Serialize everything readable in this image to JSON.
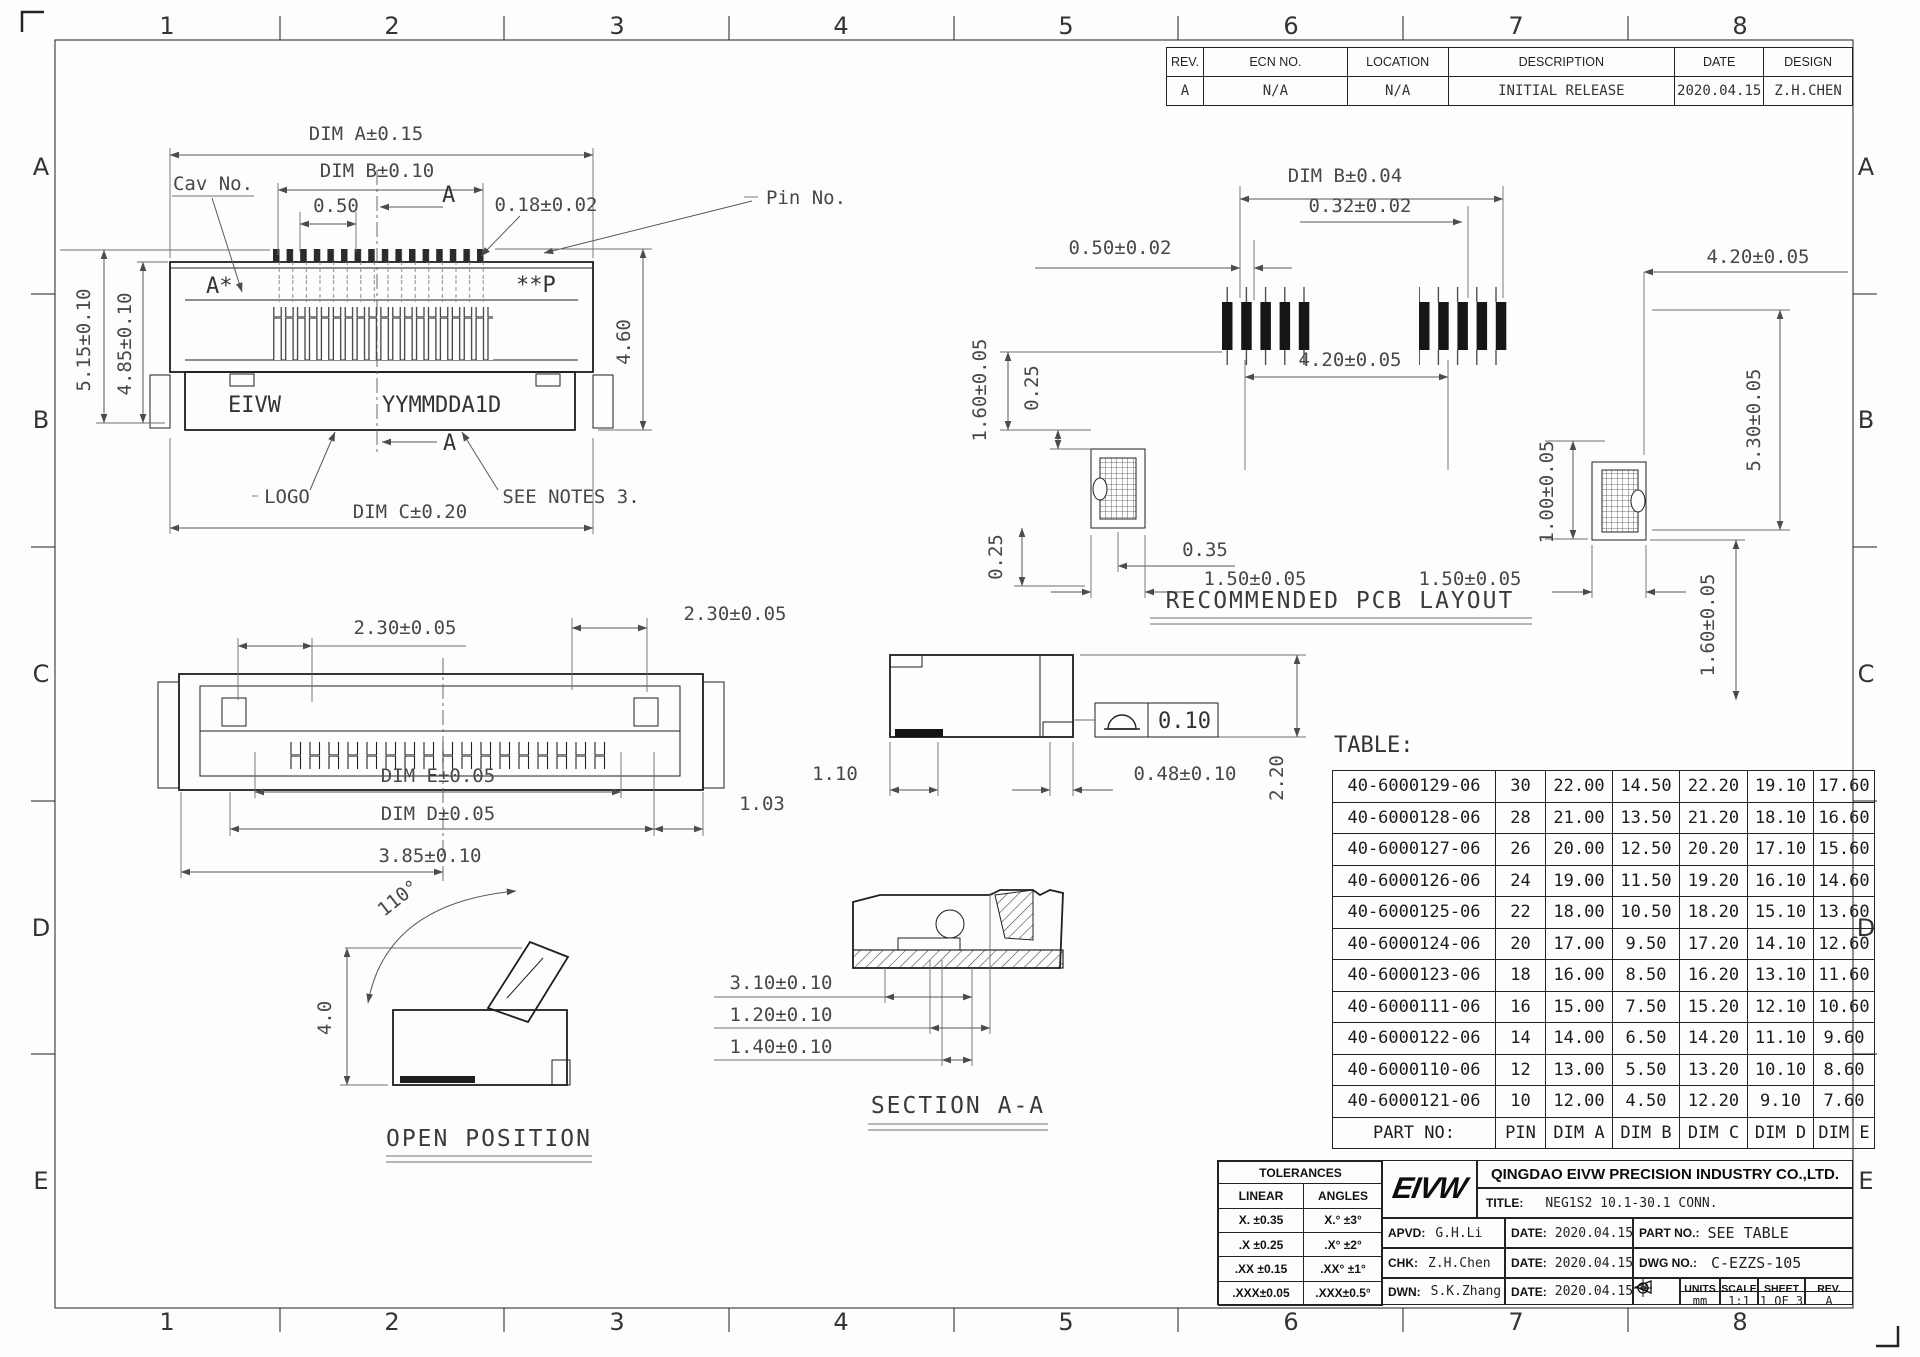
{
  "zones": {
    "cols": [
      "1",
      "2",
      "3",
      "4",
      "5",
      "6",
      "7",
      "8"
    ],
    "rows": [
      "A",
      "B",
      "C",
      "D",
      "E"
    ]
  },
  "revision_table": {
    "headers": [
      "REV.",
      "ECN NO.",
      "LOCATION",
      "DESCRIPTION",
      "DATE",
      "DESIGN"
    ],
    "row": [
      "A",
      "N/A",
      "N/A",
      "INITIAL RELEASE",
      "2020.04.15",
      "Z.H.CHEN"
    ]
  },
  "front_view": {
    "dim_a": "DIM A±0.15",
    "dim_b": "DIM B±0.10",
    "pitch": "0.50",
    "section_mark": "A",
    "section_mark_bottom": "A",
    "pin_width": "0.18±0.02",
    "cav_no": "Cav No.",
    "pin_no": "Pin No.",
    "mark_start": "A*",
    "mark_end": "**P",
    "brand": "EIVW",
    "date_code": "YYMMDDA1D",
    "logo_label": "LOGO",
    "notes_label": "SEE NOTES 3.",
    "dim_c": "DIM C±0.20",
    "height_outer": "5.15±0.10",
    "height_inner": "4.85±0.10",
    "depth": "4.60"
  },
  "pcb_view": {
    "dim_b": "DIM B±0.04",
    "pad_pitch": "0.50±0.02",
    "pad_width": "0.32±0.02",
    "span_right": "4.20±0.05",
    "span_center": "4.20±0.05",
    "edge_top": "1.60±0.05",
    "gap_top": "0.25",
    "gap_bottom": "0.25",
    "notch": "0.35",
    "anchor_left": "1.50±0.05",
    "anchor_right": "1.50±0.05",
    "offset_v": "1.00±0.05",
    "height_v": "5.30±0.05",
    "edge_bottom": "1.60±0.05",
    "caption": "RECOMMENDED PCB LAYOUT"
  },
  "bottom_view": {
    "tail_left": "2.30±0.05",
    "tail_right": "2.30±0.05",
    "dim_e": "DIM E±0.05",
    "dim_d": "DIM D±0.05",
    "overall": "3.85±0.10",
    "offset": "1.03"
  },
  "side_view": {
    "foot": "1.10",
    "tail": "0.48±0.10",
    "height": "2.20",
    "flatness": "0.10"
  },
  "open_view": {
    "angle": "110°",
    "height": "4.0",
    "caption": "OPEN POSITION"
  },
  "section_view": {
    "d1": "3.10±0.10",
    "d2": "1.20±0.10",
    "d3": "1.40±0.10",
    "caption": "SECTION A-A"
  },
  "part_table": {
    "label": "TABLE:",
    "columns": [
      "PART NO:",
      "PIN",
      "DIM A",
      "DIM B",
      "DIM C",
      "DIM D",
      "DIM E"
    ],
    "rows": [
      [
        "40-6000129-06",
        "30",
        "22.00",
        "14.50",
        "22.20",
        "19.10",
        "17.60"
      ],
      [
        "40-6000128-06",
        "28",
        "21.00",
        "13.50",
        "21.20",
        "18.10",
        "16.60"
      ],
      [
        "40-6000127-06",
        "26",
        "20.00",
        "12.50",
        "20.20",
        "17.10",
        "15.60"
      ],
      [
        "40-6000126-06",
        "24",
        "19.00",
        "11.50",
        "19.20",
        "16.10",
        "14.60"
      ],
      [
        "40-6000125-06",
        "22",
        "18.00",
        "10.50",
        "18.20",
        "15.10",
        "13.60"
      ],
      [
        "40-6000124-06",
        "20",
        "17.00",
        "9.50",
        "17.20",
        "14.10",
        "12.60"
      ],
      [
        "40-6000123-06",
        "18",
        "16.00",
        "8.50",
        "16.20",
        "13.10",
        "11.60"
      ],
      [
        "40-6000111-06",
        "16",
        "15.00",
        "7.50",
        "15.20",
        "12.10",
        "10.60"
      ],
      [
        "40-6000122-06",
        "14",
        "14.00",
        "6.50",
        "14.20",
        "11.10",
        "9.60"
      ],
      [
        "40-6000110-06",
        "12",
        "13.00",
        "5.50",
        "13.20",
        "10.10",
        "8.60"
      ],
      [
        "40-6000121-06",
        "10",
        "12.00",
        "4.50",
        "12.20",
        "9.10",
        "7.60"
      ]
    ]
  },
  "title_block": {
    "tolerances": {
      "title": "TOLERANCES",
      "linear_label": "LINEAR",
      "angles_label": "ANGLES",
      "rows": [
        [
          "X.  ±0.35",
          "X.°  ±3°"
        ],
        [
          ".X  ±0.25",
          ".X°  ±2°"
        ],
        [
          ".XX ±0.15",
          ".XX° ±1°"
        ],
        [
          ".XXX±0.05",
          ".XXX±0.5°"
        ]
      ]
    },
    "logo": "EIVW",
    "company": "QINGDAO EIVW PRECISION INDUSTRY CO.,LTD.",
    "title_label": "TITLE:",
    "title": "NEG1S2 10.1-30.1 CONN.",
    "apvd_label": "APVD:",
    "apvd": "G.H.Li",
    "chk_label": "CHK:",
    "chk": "Z.H.Chen",
    "dwn_label": "DWN:",
    "dwn": "S.K.Zhang",
    "date_label": "DATE:",
    "date": "2020.04.15",
    "part_no_label": "PART NO.:",
    "part_no": "SEE TABLE",
    "dwg_no_label": "DWG NO.:",
    "dwg_no": "C-EZZS-105",
    "units_label": "UNITS",
    "units": "mm",
    "scale_label": "SCALE",
    "scale": "1:1",
    "sheet_label": "SHEET",
    "sheet": "1 OF 3",
    "rev_label": "REV.",
    "rev": "A"
  }
}
